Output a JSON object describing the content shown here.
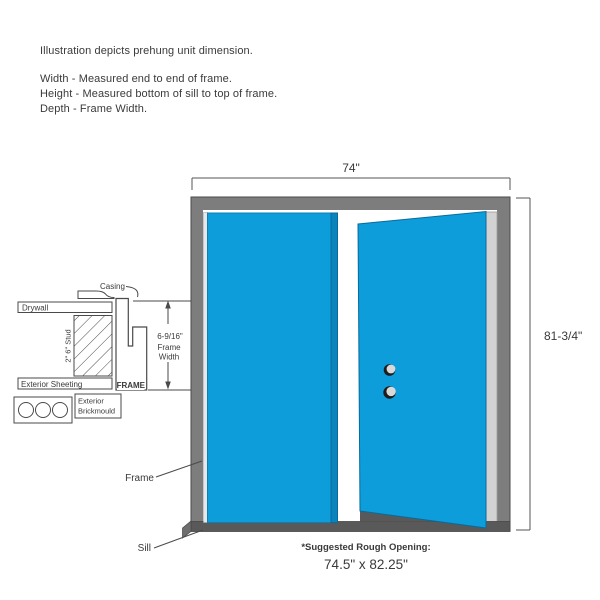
{
  "intro": {
    "line1": "Illustration depicts prehung unit dimension.",
    "line2": "Width - Measured end to end of frame.",
    "line3": "Height - Measured bottom of sill to top of frame.",
    "line4": "Depth - Frame Width."
  },
  "unit": {
    "width_label": "74\"",
    "height_label": "81-3/4\"",
    "frame_label": "Frame",
    "sill_label": "Sill"
  },
  "cross_section": {
    "casing_label": "Casing",
    "drywall_label": "Drywall",
    "stud_label": "2\" 6\" Stud",
    "exterior_sheeting_label": "Exterior Sheeting",
    "frame_label": "FRAME",
    "brickmould_label_line1": "Exterior",
    "brickmould_label_line2": "Brickmould",
    "frame_width_value": "6-9/16\"",
    "frame_width_label_line1": "Frame",
    "frame_width_label_line2": "Width"
  },
  "rough_opening": {
    "note": "*Suggested Rough Opening:",
    "value": "74.5\" x 82.25\""
  },
  "colors": {
    "door_blue": "#0d9ddb",
    "door_edge_blue": "#0a84bb",
    "frame_gray": "#7d7d7d",
    "sill_gray": "#595959",
    "jamb_light_gray": "#d2d2d2",
    "line": "#4a4a4a",
    "text": "#3a3a3a"
  }
}
